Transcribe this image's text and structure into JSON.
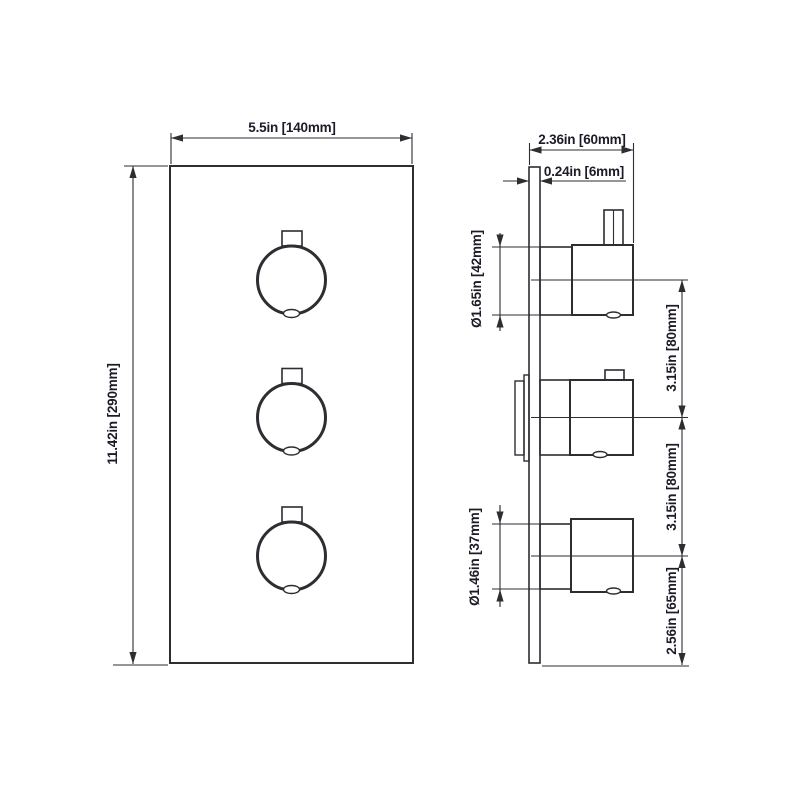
{
  "front_view": {
    "width_label": "5.5in [140mm]",
    "height_label": "11.42in [290mm]"
  },
  "side_view": {
    "depth_label": "2.36in [60mm]",
    "plate_thickness_label": "0.24in [6mm]",
    "top_knob_diameter_label": "Ø1.65in [42mm]",
    "bottom_knob_diameter_label": "Ø1.46in [37mm]",
    "knob_spacing_upper_label": "3.15in [80mm]",
    "knob_spacing_lower_label": "3.15in [80mm]",
    "bottom_offset_label": "2.56in [65mm]"
  },
  "colors": {
    "line": "#2d2d32",
    "text": "#1c1c28",
    "background": "#ffffff"
  }
}
